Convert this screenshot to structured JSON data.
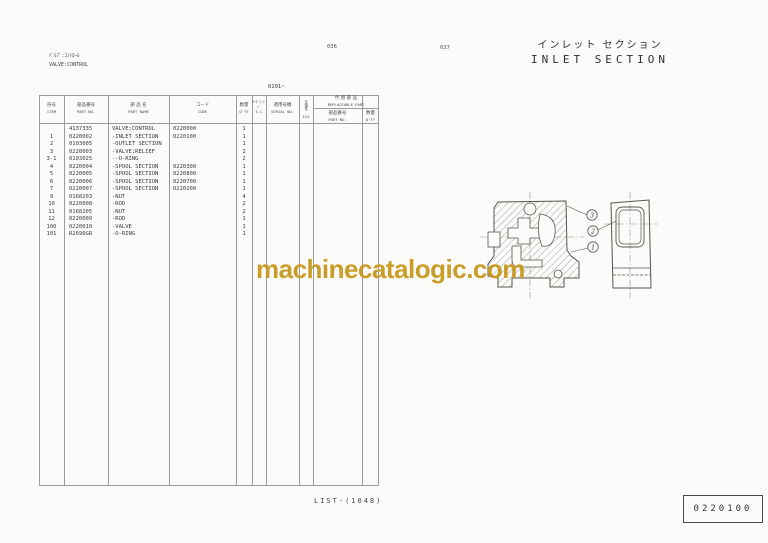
{
  "page": {
    "top_left": {
      "label_jp": "ﾊﾞﾙﾌﾞ:ｺﾝﾄﾛｰﾙ",
      "label_en": "VALVE:CONTROL"
    },
    "page_numbers": {
      "left": "036",
      "right": "037"
    },
    "title": {
      "jp": "インレット セクション",
      "en": "INLET SECTION"
    },
    "serial_range": "0101~",
    "footer": {
      "list_ref": "LIST-(1048)",
      "code_box": "0220100"
    },
    "watermark": {
      "text": "machinecatalogic.com",
      "color": "#c8991e"
    }
  },
  "table": {
    "columns": [
      {
        "jp": "符号",
        "en": "ITEM"
      },
      {
        "jp": "部品番号",
        "en": "PART NO."
      },
      {
        "jp": "部 品 名",
        "en": "PART NAME"
      },
      {
        "jp": "コード",
        "en": "CODE"
      },
      {
        "jp": "数量",
        "en": "Q'TY"
      },
      {
        "jp": "ｻｰﾋﾞｽ ｺｰﾄﾞ",
        "en": "S-C"
      },
      {
        "jp": "適用号機",
        "en": "SERIAL NO."
      },
      {
        "jp": "互換性",
        "en": "ICA"
      },
      {
        "jp": "部品番号",
        "en": "PART NO."
      },
      {
        "jp": "数量",
        "en": "Q'TY"
      }
    ],
    "replaceable_part": {
      "jp": "代 替 部 品",
      "en": "REPLACEABLE PART"
    },
    "rows": [
      {
        "item": "",
        "part_no": "4137335",
        "part_name": "VALVE;CONTROL",
        "code": "0220000",
        "qty": "1"
      },
      {
        "item": "1",
        "part_no": "0220002",
        "part_name": "-INLET SECTION",
        "code": "0220100",
        "qty": "1"
      },
      {
        "item": "2",
        "part_no": "0103005",
        "part_name": "-OUTLET SECTION",
        "code": "",
        "qty": "1"
      },
      {
        "item": "3",
        "part_no": "0220003",
        "part_name": "-VALVE;RELIEF",
        "code": "",
        "qty": "2"
      },
      {
        "item": "3-1",
        "part_no": "0103025",
        "part_name": "--O-RING",
        "code": "",
        "qty": "2"
      },
      {
        "item": "4",
        "part_no": "0220004",
        "part_name": "-SPOOL SECTION",
        "code": "0220300",
        "qty": "1"
      },
      {
        "item": "5",
        "part_no": "0220005",
        "part_name": "-SPOOL SECTION",
        "code": "0220800",
        "qty": "1"
      },
      {
        "item": "6",
        "part_no": "0220006",
        "part_name": "-SPOOL SECTION",
        "code": "0220700",
        "qty": "1"
      },
      {
        "item": "7",
        "part_no": "0220007",
        "part_name": "-SPOOL SECTION",
        "code": "0220200",
        "qty": "1"
      },
      {
        "item": "9",
        "part_no": "0168203",
        "part_name": "-NUT",
        "code": "",
        "qty": "4"
      },
      {
        "item": "10",
        "part_no": "0220008",
        "part_name": "-ROD",
        "code": "",
        "qty": "2"
      },
      {
        "item": "11",
        "part_no": "0168205",
        "part_name": "-NUT",
        "code": "",
        "qty": "2"
      },
      {
        "item": "12",
        "part_no": "0220009",
        "part_name": "-ROD",
        "code": "",
        "qty": "1"
      },
      {
        "item": "100",
        "part_no": "0220010",
        "part_name": "-VALVE",
        "code": "",
        "qty": "1"
      },
      {
        "item": "101",
        "part_no": "R2690GR",
        "part_name": "-O-RING",
        "code": "",
        "qty": "1"
      }
    ]
  },
  "drawing": {
    "callouts": [
      "3",
      "2",
      "1"
    ]
  }
}
